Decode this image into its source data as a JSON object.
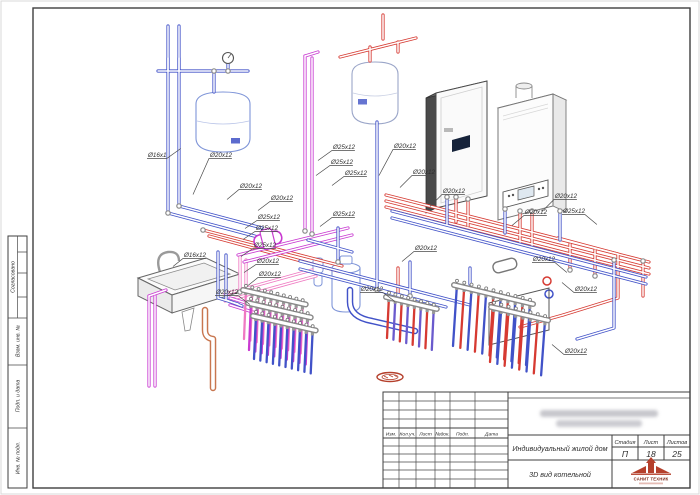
{
  "colors": {
    "blue": "#4152c8",
    "red": "#d63a32",
    "magenta": "#c93ad1",
    "pink": "#ef7ac2",
    "purple": "#6a5acd",
    "orange": "#c8764f",
    "fitting_gray": "#8a8a8a",
    "frame": "#3f3f3f",
    "logo_red": "#b5402c"
  },
  "side_stamp": {
    "approved": "Согласовано",
    "replace_inv": "Взам. инв. №",
    "sign_date": "Подп. и дата",
    "inv_orig": "Инв. № подл."
  },
  "title_block": {
    "rev_headers": [
      "Изм.",
      "Кол.уч.",
      "Лист",
      "№док.",
      "Подп.",
      "Дата"
    ],
    "location_redacted": true,
    "object_name": "Индивидуальный жилой дом",
    "drawing_title": "3D вид котельной",
    "stage_label": "Стадия",
    "sheet_label": "Лист",
    "sheets_label": "Листов",
    "stage": "П",
    "sheet_no": "18",
    "sheets_total": "25",
    "company_name": "САНИТ ТЕХНИК"
  },
  "drawing": {
    "callouts": [
      {
        "text": "Ø16x1",
        "x": 148,
        "y": 157,
        "dx": 14,
        "dy": -10
      },
      {
        "text": "Ø20x12",
        "x": 210,
        "y": 157,
        "dx": -16,
        "dy": 36
      },
      {
        "text": "Ø25x12",
        "x": 333,
        "y": 149,
        "dx": -14,
        "dy": 10
      },
      {
        "text": "Ø25x12",
        "x": 331,
        "y": 164,
        "dx": -14,
        "dy": 10
      },
      {
        "text": "Ø20x12",
        "x": 394,
        "y": 148,
        "dx": -14,
        "dy": 26
      },
      {
        "text": "Ø20x12",
        "x": 240,
        "y": 188,
        "dx": -12,
        "dy": 10
      },
      {
        "text": "Ø25x12",
        "x": 345,
        "y": 175,
        "dx": -12,
        "dy": 9
      },
      {
        "text": "Ø20x12",
        "x": 271,
        "y": 200,
        "dx": -12,
        "dy": 9
      },
      {
        "text": "Ø25x12",
        "x": 258,
        "y": 219,
        "dx": -12,
        "dy": 8
      },
      {
        "text": "Ø25x12",
        "x": 256,
        "y": 230,
        "dx": -12,
        "dy": 8
      },
      {
        "text": "Ø25x12",
        "x": 333,
        "y": 216,
        "dx": -12,
        "dy": 9
      },
      {
        "text": "Ø25x12",
        "x": 254,
        "y": 247,
        "dx": -12,
        "dy": 8
      },
      {
        "text": "Ø20x12",
        "x": 257,
        "y": 263,
        "dx": -12,
        "dy": 8
      },
      {
        "text": "Ø16x12",
        "x": 184,
        "y": 257,
        "dx": -10,
        "dy": 8
      },
      {
        "text": "Ø20x12",
        "x": 216,
        "y": 294,
        "dx": 12,
        "dy": 9
      },
      {
        "text": "Ø20x12",
        "x": 259,
        "y": 276,
        "dx": -10,
        "dy": 8
      },
      {
        "text": "Ø20x12",
        "x": 361,
        "y": 291,
        "dx": 12,
        "dy": 9
      },
      {
        "text": "Ø20x12",
        "x": 413,
        "y": 174,
        "dx": -12,
        "dy": 12
      },
      {
        "text": "Ø20x12",
        "x": 443,
        "y": 193,
        "dx": -12,
        "dy": 12
      },
      {
        "text": "Ø20x12",
        "x": 555,
        "y": 198,
        "dx": -12,
        "dy": 12
      },
      {
        "text": "Ø20x12",
        "x": 525,
        "y": 214,
        "dx": -12,
        "dy": 10
      },
      {
        "text": "Ø25x12",
        "x": 563,
        "y": 213,
        "dx": 12,
        "dy": 10
      },
      {
        "text": "Ø20x12",
        "x": 415,
        "y": 250,
        "dx": -12,
        "dy": 10
      },
      {
        "text": "Ø20x12",
        "x": 533,
        "y": 261,
        "dx": 12,
        "dy": 10
      },
      {
        "text": "Ø20x12",
        "x": 575,
        "y": 291,
        "dx": -12,
        "dy": -10
      },
      {
        "text": "Ø20x12",
        "x": 565,
        "y": 353,
        "dx": -12,
        "dy": -10
      }
    ]
  }
}
